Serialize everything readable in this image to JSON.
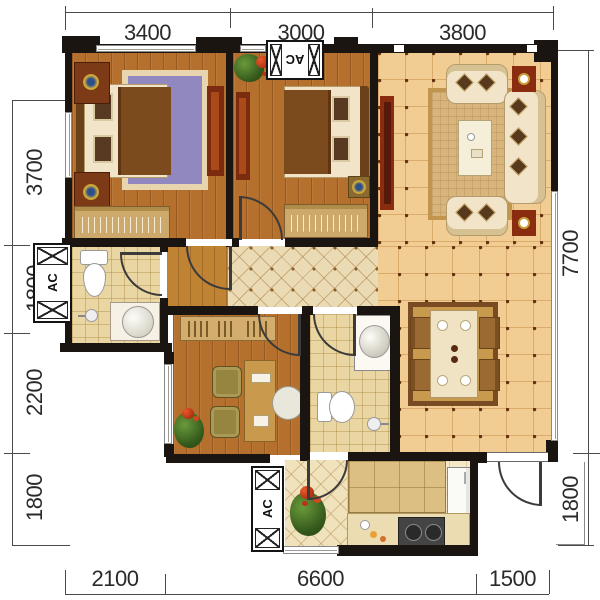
{
  "dimensions": {
    "top": [
      "3400",
      "3000",
      "3800"
    ],
    "left": [
      "3700",
      "1800",
      "2200",
      "1800"
    ],
    "right": [
      "7700",
      "1800"
    ],
    "bottom": [
      "2100",
      "6600",
      "1500"
    ]
  },
  "ac_label": "AC",
  "colors": {
    "wall": "#1a1510",
    "wood_floor": "#b4702c",
    "hall_wood": "#c08334",
    "living_tile": "#f1cd94",
    "tile_dot": "#63300f",
    "hall_diamond_tile": "#eadbb4",
    "bath_tile": "#e9d6a2",
    "kitchen_floor": "#f4e8c8",
    "accent_red": "#7c2b10",
    "sofa_cream": "#f1e4c8",
    "rug_blue": "#9188bf",
    "rug_tan": "#d9b57e",
    "dining_rug": "#c89a4e",
    "dimension_text": "#2a2a2a"
  }
}
